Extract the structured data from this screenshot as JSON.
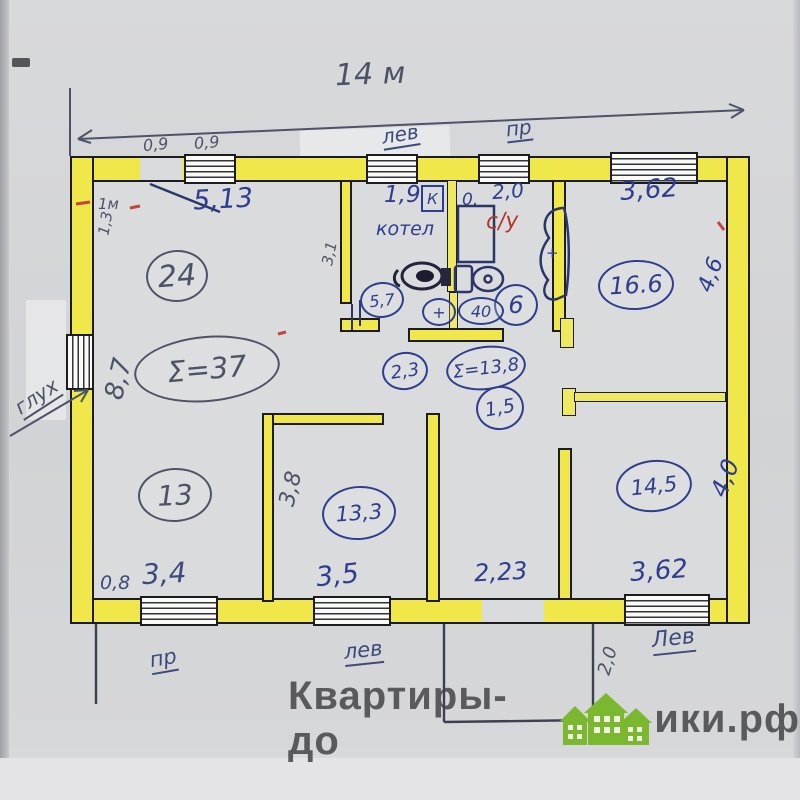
{
  "plan": {
    "top_dimension": "14 м",
    "door_widths": {
      "a": "0,9",
      "b": "0,9"
    },
    "window_labels": {
      "top_mid": "лев",
      "top_right": "пр",
      "bottom_left": "пр",
      "bottom_mid": "лев",
      "bottom_right": "Лев",
      "left_wall": "глух"
    },
    "dimensions_top": {
      "living_width": "5,13",
      "boiler_width": "1,9",
      "gap": "0.",
      "bath_width": "2,0",
      "room_right_width": "3,62"
    },
    "dimensions_side": {
      "left_height": "8,7",
      "left_top": "1,3",
      "left_door": "1м",
      "boiler_depth": "3,1",
      "right_top": "4,6",
      "right_bottom": "4,0",
      "bed_mid_depth": "3,8",
      "porch_depth": "2,0"
    },
    "dimensions_bottom": {
      "bed_left_a": "0,8",
      "bed_left_b": "3,4",
      "bed_mid": "3,5",
      "hall_width": "2,23",
      "bed_right": "3,62"
    },
    "rooms": {
      "living_area": "24",
      "left_sum": "Σ=37",
      "boiler_label": "котел",
      "boiler_area": "5,7",
      "boiler_icon": "К",
      "bath_label": "с/у",
      "bath_area": "6",
      "fixture_40": "40",
      "fixture_plus": "+",
      "bath_plus": "+",
      "room_right_area": "16.6",
      "hall_sum": "Σ=13,8",
      "hall_a": "2,3",
      "hall_b": "1,5",
      "bed_left_area": "13",
      "bed_mid_area": "13,3",
      "bed_right_area": "14,5"
    }
  },
  "watermark": {
    "prefix": "Квартиры-до",
    "suffix": "ики.рф"
  },
  "colors": {
    "wall_highlight": "#f0e74b",
    "ink_blue": "#2e3d8f",
    "pencil": "#4d5366",
    "ink_red": "#b43427",
    "watermark_green": "#7cb82f",
    "watermark_gray": "#444446"
  }
}
